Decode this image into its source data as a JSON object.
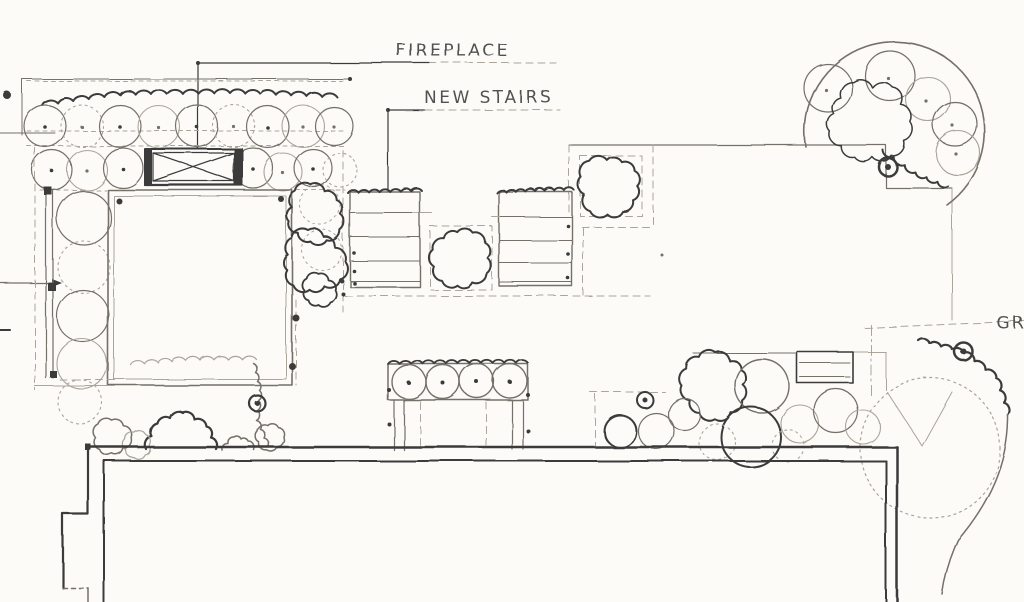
{
  "palette": {
    "paper": "#fcfbf8",
    "ink": "#3b3b3b",
    "med": "#746f68",
    "fnt": "#aaa49b"
  },
  "labels": {
    "fireplace": "FIREPLACE",
    "new_stairs": "NEW STAIRS",
    "edge_label": "GR"
  }
}
